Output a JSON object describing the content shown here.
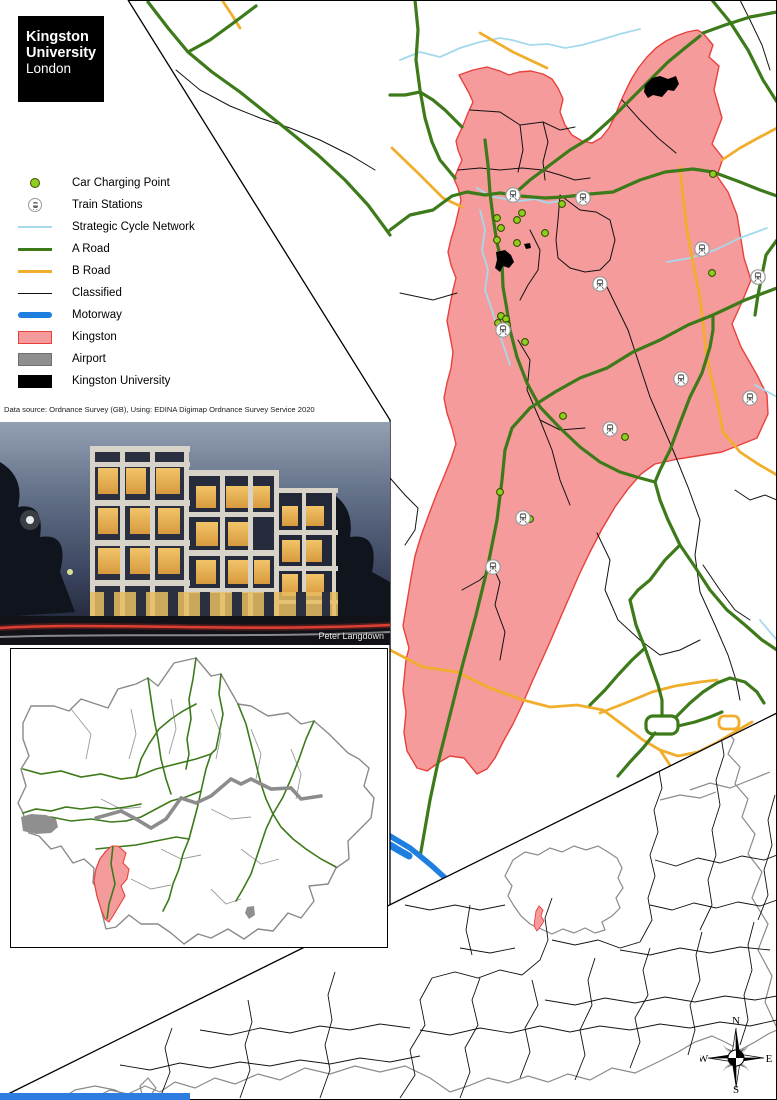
{
  "logo": {
    "line1": "Kingston",
    "line2": "University",
    "line3": "London"
  },
  "legend": {
    "items": [
      {
        "label": "Car Charging Point",
        "type": "charging-point"
      },
      {
        "label": "Train Stations",
        "type": "train-station"
      },
      {
        "label": "Strategic Cycle Network",
        "type": "cycle-line"
      },
      {
        "label": "A Road",
        "type": "a-road-line"
      },
      {
        "label": "B Road",
        "type": "b-road-line"
      },
      {
        "label": "Classified",
        "type": "classified-line"
      },
      {
        "label": "Motorway",
        "type": "motorway-line"
      },
      {
        "label": "Kingston",
        "type": "kingston-fill"
      },
      {
        "label": "Airport",
        "type": "airport-fill"
      },
      {
        "label": "Kingston University",
        "type": "university-fill"
      }
    ]
  },
  "attribution": "Data source: Ordnance Survey (GB), Using: EDINA Digimap Ordnance Survey Service 2020",
  "photo": {
    "credit": "Peter Langdown"
  },
  "compass": {
    "north": "N",
    "south": "S",
    "east": "E",
    "west": "W"
  },
  "colors": {
    "kingston_fill": "#F59B9B",
    "kingston_border": "#E8413C",
    "a_road": "#3D7A1A",
    "b_road": "#F0AE2C",
    "classified": "#111111",
    "cycle_network": "#A5D9EE",
    "motorway": "#1E7FE0",
    "airport_gray": "#8f8f8f",
    "university_black": "#000000",
    "charging_point": "#8CCF1F"
  },
  "main_map": {
    "train_stations": [
      [
        513,
        195
      ],
      [
        583,
        198
      ],
      [
        600,
        284
      ],
      [
        503,
        330
      ],
      [
        702,
        249
      ],
      [
        758,
        277
      ],
      [
        681,
        379
      ],
      [
        750,
        398
      ],
      [
        610,
        429
      ],
      [
        523,
        518
      ],
      [
        493,
        567
      ]
    ],
    "charging_points": [
      [
        497,
        218
      ],
      [
        501,
        228
      ],
      [
        497,
        240
      ],
      [
        517,
        220
      ],
      [
        522,
        213
      ],
      [
        545,
        233
      ],
      [
        562,
        204
      ],
      [
        517,
        243
      ],
      [
        713,
        174
      ],
      [
        712,
        273
      ],
      [
        501,
        316
      ],
      [
        506,
        319
      ],
      [
        498,
        323
      ],
      [
        507,
        325
      ],
      [
        525,
        342
      ],
      [
        563,
        416
      ],
      [
        625,
        437
      ],
      [
        530,
        519
      ],
      [
        500,
        492
      ]
    ]
  }
}
